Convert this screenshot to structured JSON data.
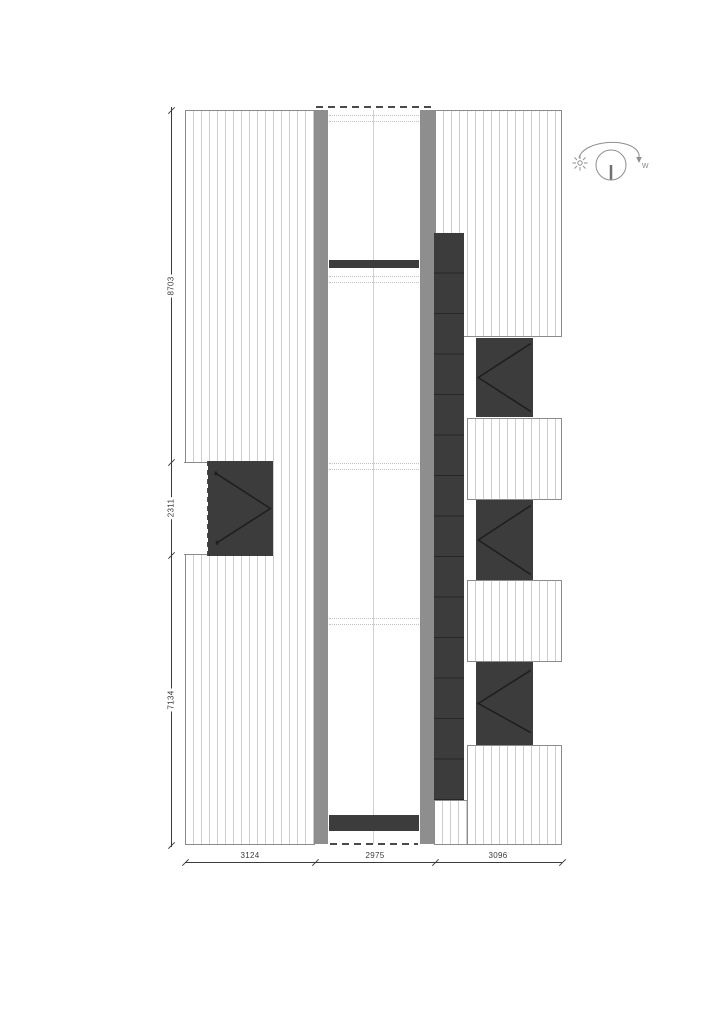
{
  "drawing": {
    "kind_label": "roof plan",
    "dims": {
      "left": [
        "8703",
        "2311",
        "7134"
      ],
      "bottom": [
        "3124",
        "2975",
        "3096"
      ]
    },
    "sun_path": {
      "west_label": "w"
    }
  },
  "colors": {
    "hatch-line": "#cdcdcd",
    "roof-border": "#8b8b8b",
    "strip": "#8e8e8e",
    "dark": "#3c3c3c",
    "panel-line": "#262626",
    "chevron": "#1f1f1f",
    "dash": "#4a4a4a",
    "dotted": "#c3c3c3",
    "centerline": "#d0d0d0",
    "dim": "#3a3a3a",
    "symbol": "#8f8f8f"
  }
}
